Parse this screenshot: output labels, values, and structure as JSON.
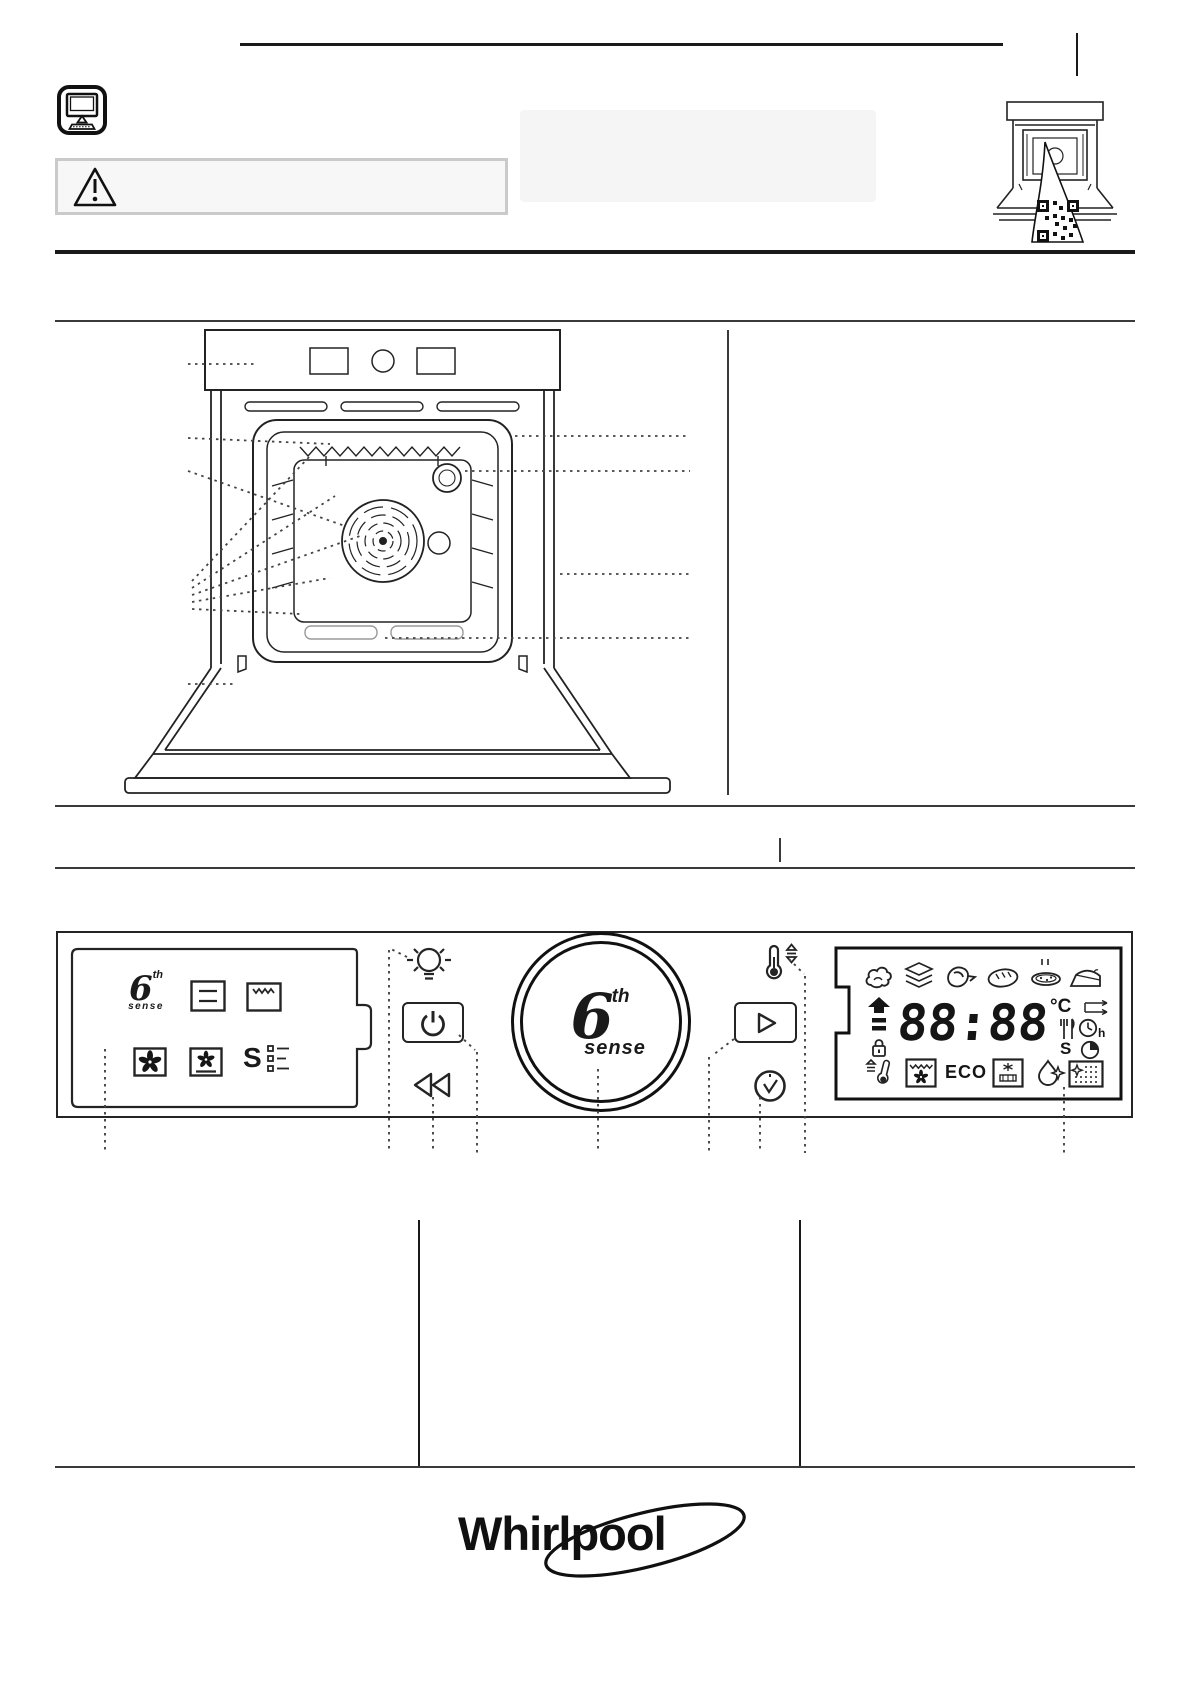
{
  "document": {
    "type": "oven-quick-guide-page"
  },
  "colors": {
    "ink": "#1a1a1a",
    "rule": "#3a3a3a",
    "panel_fill": "#f5f5f5",
    "warning_border": "#cacaca"
  },
  "header": {
    "monitor_icon": "monitor-icon",
    "warning_icon": "warning-triangle-icon",
    "oven_sticker_icon": "oven-qr-sticker-icon"
  },
  "figure": {
    "name": "oven-front-diagram"
  },
  "control_panel": {
    "functions_box": {
      "logo": {
        "digit": "6",
        "sup": "th",
        "word": "sense"
      },
      "special_label": "S",
      "icons": [
        "sixth-sense-logo",
        "static-icon",
        "grill-icon",
        "fan-icon",
        "fan-bake-icon",
        "special-functions-icon"
      ]
    },
    "buttons": {
      "icons": [
        "lamp-icon",
        "power-icon",
        "back-icon",
        "temperature-icon",
        "start-icon",
        "clock-icon"
      ]
    },
    "knob": {
      "logo": {
        "digit": "6",
        "sup": "th",
        "word": "sense"
      }
    },
    "display": {
      "time": "88:88",
      "temp_unit": "°C",
      "eco_label": "ECO",
      "sound_label": "S",
      "hour_label": "h",
      "food_icons": [
        "steam-icon",
        "layers-icon",
        "poultry-icon",
        "bread-icon",
        "pizza-icon",
        "cake-icon"
      ],
      "status_icons": [
        "shelf-level-icon",
        "lock-icon",
        "tray-icon",
        "cutlery-icon",
        "duration-icon",
        "timer-icon"
      ],
      "function_icons": [
        "preheat-icon",
        "grill-fan-icon",
        "steam-clean-icon",
        "clean-icon",
        "pyro-icon"
      ]
    }
  },
  "footer": {
    "brand": "Whirlpool"
  }
}
